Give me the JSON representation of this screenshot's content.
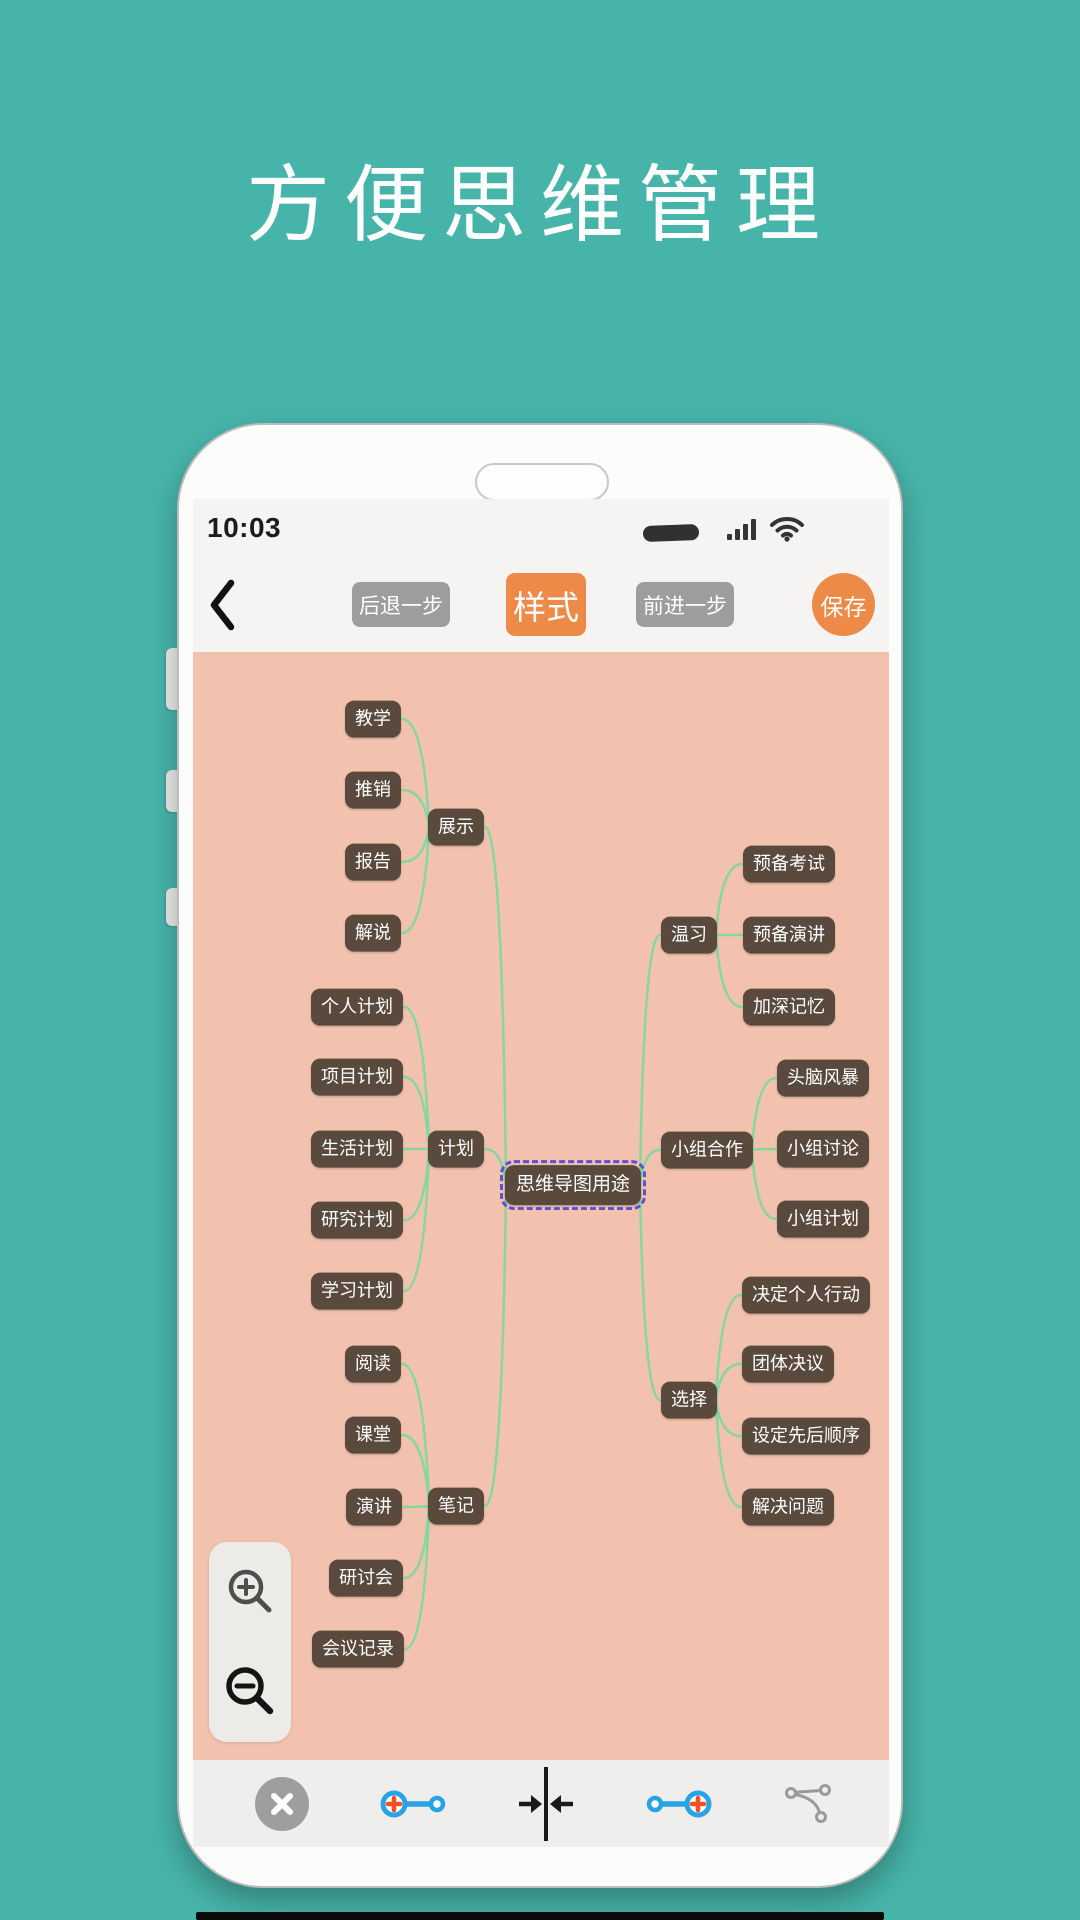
{
  "page": {
    "title": "方便思维管理",
    "background_color": "#47b4aa"
  },
  "statusbar": {
    "time": "10:03"
  },
  "toolbar": {
    "undo_label": "后退一步",
    "style_label": "样式",
    "redo_label": "前进一步",
    "save_label": "保存",
    "accent_color": "#ee8a48",
    "gray_button_color": "#9d9d9d"
  },
  "mindmap": {
    "canvas_color": "#f2c2ae",
    "node_color": "#594a3d",
    "node_text_color": "#ffffff",
    "edge_color": "#7fd7a0",
    "selection_dash_color": "#5b50d6",
    "nodes": [
      {
        "id": "center",
        "label": "思维导图用途",
        "x": 380,
        "y": 533,
        "type": "center"
      },
      {
        "id": "zhanshi",
        "label": "展示",
        "x": 263,
        "y": 175,
        "type": "branch"
      },
      {
        "id": "jihua",
        "label": "计划",
        "x": 263,
        "y": 497,
        "type": "branch"
      },
      {
        "id": "biji",
        "label": "笔记",
        "x": 263,
        "y": 854,
        "type": "branch"
      },
      {
        "id": "wenxi",
        "label": "温习",
        "x": 496,
        "y": 283,
        "type": "branch"
      },
      {
        "id": "xiaozuhezuo",
        "label": "小组合作",
        "x": 514,
        "y": 498,
        "type": "branch"
      },
      {
        "id": "xuanze",
        "label": "选择",
        "x": 496,
        "y": 748,
        "type": "branch"
      },
      {
        "id": "jiaoxue",
        "label": "教学",
        "x": 180,
        "y": 67,
        "type": "leaf"
      },
      {
        "id": "tuixiao",
        "label": "推销",
        "x": 180,
        "y": 138,
        "type": "leaf"
      },
      {
        "id": "baogao",
        "label": "报告",
        "x": 180,
        "y": 210,
        "type": "leaf"
      },
      {
        "id": "jieshuo",
        "label": "解说",
        "x": 180,
        "y": 281,
        "type": "leaf"
      },
      {
        "id": "gerenjihua",
        "label": "个人计划",
        "x": 164,
        "y": 355,
        "type": "leaf"
      },
      {
        "id": "xiangmujihua",
        "label": "项目计划",
        "x": 164,
        "y": 425,
        "type": "leaf"
      },
      {
        "id": "shenghuojihua",
        "label": "生活计划",
        "x": 164,
        "y": 497,
        "type": "leaf"
      },
      {
        "id": "yanjiujihua",
        "label": "研究计划",
        "x": 164,
        "y": 568,
        "type": "leaf"
      },
      {
        "id": "xuexijihua",
        "label": "学习计划",
        "x": 164,
        "y": 639,
        "type": "leaf"
      },
      {
        "id": "yuedu",
        "label": "阅读",
        "x": 180,
        "y": 712,
        "type": "leaf"
      },
      {
        "id": "ketang",
        "label": "课堂",
        "x": 180,
        "y": 783,
        "type": "leaf"
      },
      {
        "id": "yanjiang",
        "label": "演讲",
        "x": 181,
        "y": 855,
        "type": "leaf"
      },
      {
        "id": "yantaohui",
        "label": "研讨会",
        "x": 173,
        "y": 926,
        "type": "leaf"
      },
      {
        "id": "huiyijilu",
        "label": "会议记录",
        "x": 165,
        "y": 997,
        "type": "leaf"
      },
      {
        "id": "yubeikaoshi",
        "label": "预备考试",
        "x": 596,
        "y": 212,
        "type": "leaf"
      },
      {
        "id": "yubeiyanjiang",
        "label": "预备演讲",
        "x": 596,
        "y": 283,
        "type": "leaf"
      },
      {
        "id": "jiashenjiyi",
        "label": "加深记忆",
        "x": 596,
        "y": 355,
        "type": "leaf"
      },
      {
        "id": "tounaofengbao",
        "label": "头脑风暴",
        "x": 630,
        "y": 426,
        "type": "leaf"
      },
      {
        "id": "xiaozutaolun",
        "label": "小组讨论",
        "x": 630,
        "y": 497,
        "type": "leaf"
      },
      {
        "id": "xiaozujihua",
        "label": "小组计划",
        "x": 630,
        "y": 567,
        "type": "leaf"
      },
      {
        "id": "juedinggeren",
        "label": "决定个人行动",
        "x": 613,
        "y": 643,
        "type": "leaf"
      },
      {
        "id": "tuantijueyi",
        "label": "团体决议",
        "x": 595,
        "y": 712,
        "type": "leaf"
      },
      {
        "id": "shedingshunxu",
        "label": "设定先后顺序",
        "x": 613,
        "y": 784,
        "type": "leaf"
      },
      {
        "id": "jiejuewenti",
        "label": "解决问题",
        "x": 595,
        "y": 855,
        "type": "leaf"
      }
    ],
    "edges": [
      [
        "center",
        "zhanshi"
      ],
      [
        "center",
        "jihua"
      ],
      [
        "center",
        "biji"
      ],
      [
        "center",
        "wenxi"
      ],
      [
        "center",
        "xiaozuhezuo"
      ],
      [
        "center",
        "xuanze"
      ],
      [
        "zhanshi",
        "jiaoxue"
      ],
      [
        "zhanshi",
        "tuixiao"
      ],
      [
        "zhanshi",
        "baogao"
      ],
      [
        "zhanshi",
        "jieshuo"
      ],
      [
        "jihua",
        "gerenjihua"
      ],
      [
        "jihua",
        "xiangmujihua"
      ],
      [
        "jihua",
        "shenghuojihua"
      ],
      [
        "jihua",
        "yanjiujihua"
      ],
      [
        "jihua",
        "xuexijihua"
      ],
      [
        "biji",
        "yuedu"
      ],
      [
        "biji",
        "ketang"
      ],
      [
        "biji",
        "yanjiang"
      ],
      [
        "biji",
        "yantaohui"
      ],
      [
        "biji",
        "huiyijilu"
      ],
      [
        "wenxi",
        "yubeikaoshi"
      ],
      [
        "wenxi",
        "yubeiyanjiang"
      ],
      [
        "wenxi",
        "jiashenjiyi"
      ],
      [
        "xiaozuhezuo",
        "tounaofengbao"
      ],
      [
        "xiaozuhezuo",
        "xiaozutaolun"
      ],
      [
        "xiaozuhezuo",
        "xiaozujihua"
      ],
      [
        "xuanze",
        "juedinggeren"
      ],
      [
        "xuanze",
        "tuantijueyi"
      ],
      [
        "xuanze",
        "shedingshunxu"
      ],
      [
        "xuanze",
        "jiejuewenti"
      ]
    ]
  },
  "bottom_toolbar": {
    "icons": [
      "close",
      "add-node-left",
      "collapse",
      "add-node-right",
      "structure"
    ],
    "blue": "#2aa3e6",
    "plus_orange": "#f4511e"
  }
}
